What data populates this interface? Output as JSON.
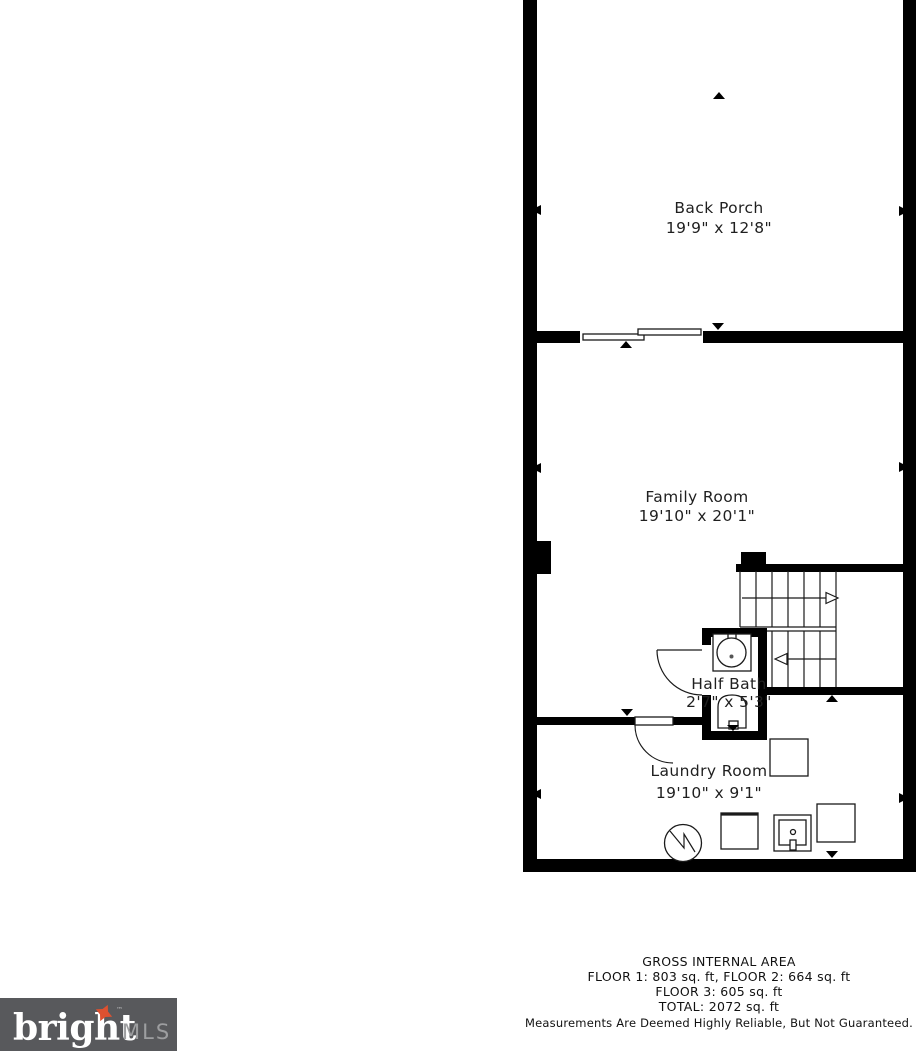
{
  "colors": {
    "wall": "#000000",
    "line": "#1a1a1a",
    "background": "#ffffff",
    "label_text": "#1f1f1f",
    "logo_bg": "#58595c",
    "logo_brand": "#ffffff",
    "logo_mls": "#9d9ea0",
    "logo_star": "#dd5130"
  },
  "rooms": {
    "back_porch": {
      "name": "Back Porch",
      "dims": "19'9\" x 12'8\""
    },
    "family_room": {
      "name": "Family Room",
      "dims": "19'10\" x 20'1\""
    },
    "half_bath": {
      "name": "Half Bath",
      "dims": "2'7\" x 5'3\""
    },
    "laundry_room": {
      "name": "Laundry Room",
      "dims": "19'10\" x 9'1\""
    }
  },
  "area_summary": {
    "title": "GROSS INTERNAL AREA",
    "floors_line_1": "FLOOR 1: 803 sq. ft, FLOOR 2: 664 sq. ft",
    "floors_line_2": "FLOOR 3: 605 sq. ft",
    "total_line": "TOTAL: 2072 sq. ft",
    "disclaimer": "Measurements Are Deemed Highly Reliable, But Not Guaranteed."
  },
  "logo": {
    "brand": "bright",
    "tm": "™",
    "suffix": "MLS"
  },
  "icons": {
    "sink": "circle-in-square with faucet",
    "toilet": "arch with tank block",
    "washer": "nested squares with center dot",
    "water_heater": "circle with zigzag",
    "storage_box": "plain square outline",
    "stairs_up_arrow": "open arrowhead pointing right",
    "stairs_down_arrow": "open arrowhead pointing left",
    "door_swing": "quarter-circle arc with leaf line",
    "sliding_door": "two offset thin panels",
    "dimension_tick": "small filled triangle on wall",
    "logo_star": "four-point orange star"
  }
}
